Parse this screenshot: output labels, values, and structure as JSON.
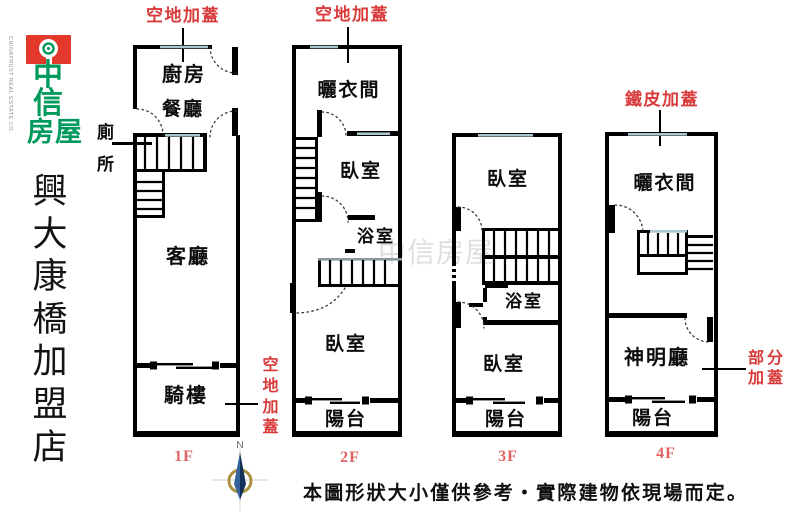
{
  "sidebar": {
    "company_en": "CHINATRUST REAL ESTATE CO.",
    "logo_chars": [
      "中",
      "信",
      "房屋"
    ],
    "store_name": "興大康橋加盟店",
    "logo_green": "#009a5c",
    "logo_red": "#e2392c"
  },
  "annotations": {
    "roof_1f_top": "空地加蓋",
    "roof_2f_top": "空地加蓋",
    "metal_roof_4f": "鐵皮加蓋",
    "roof_1f_side": "空地加蓋",
    "partial_roof_4f": "部分加蓋"
  },
  "floors": [
    {
      "label": "1F",
      "rooms": {
        "kitchen": "廚房",
        "dining": "餐廳",
        "toilet": "廁所",
        "living": "客廳",
        "arcade": "騎樓"
      }
    },
    {
      "label": "2F",
      "rooms": {
        "laundry": "曬衣間",
        "bedroom_front": "臥室",
        "bath": "浴室",
        "bedroom_back": "臥室",
        "balcony": "陽台"
      }
    },
    {
      "label": "3F",
      "rooms": {
        "bedroom_front": "臥室",
        "bath": "浴室",
        "bedroom_back": "臥室",
        "balcony": "陽台"
      }
    },
    {
      "label": "4F",
      "rooms": {
        "laundry": "曬衣間",
        "shrine": "神明廳",
        "balcony": "陽台"
      }
    }
  ],
  "compass": {
    "north_label": "N"
  },
  "watermark": {
    "text": "中信房屋"
  },
  "footer": {
    "disclaimer": "本圖形狀大小僅供參考‧實際建物依現場而定。"
  },
  "colors": {
    "wall": "#000000",
    "window": "#aac6ce",
    "annotation_red": "#d93b3b",
    "floor_label_red": "#e06464",
    "compass_ring_gold": "#aa9140",
    "compass_needle_navy": "#13305a"
  }
}
